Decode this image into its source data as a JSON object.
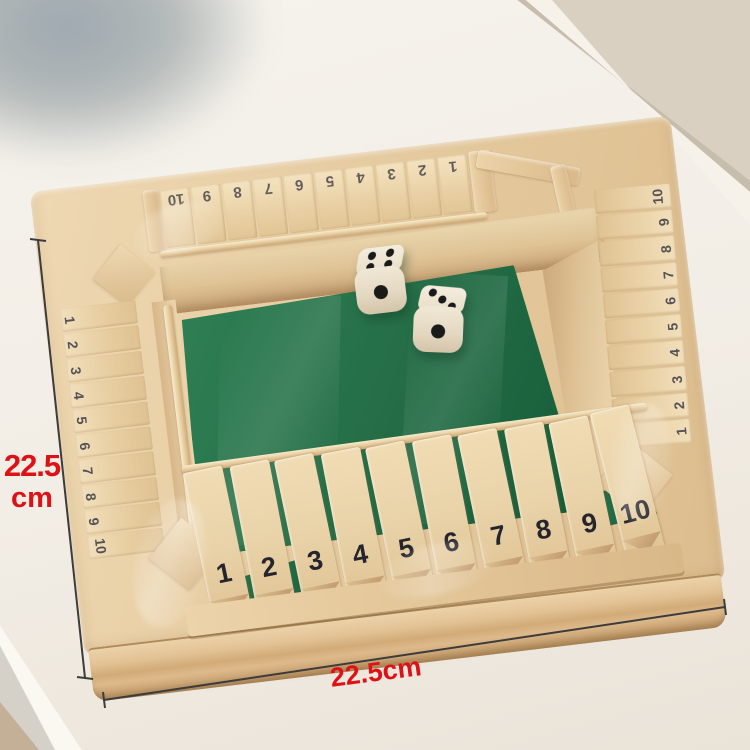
{
  "annotations": {
    "height_label": {
      "value": "22.5",
      "unit": "cm"
    },
    "width_label": {
      "text": "22.5cm"
    },
    "label_color": "#de1216",
    "line_color": "#3c3c3c"
  },
  "board": {
    "tiles": {
      "top": [
        "10",
        "9",
        "8",
        "7",
        "6",
        "5",
        "4",
        "3",
        "2",
        "1"
      ],
      "left": [
        "1",
        "2",
        "3",
        "4",
        "5",
        "6",
        "7",
        "8",
        "9",
        "10"
      ],
      "right": [
        "10",
        "9",
        "8",
        "7",
        "6",
        "5",
        "4",
        "3",
        "2",
        "1"
      ],
      "bottom": [
        "1",
        "2",
        "3",
        "4",
        "5",
        "6",
        "7",
        "8",
        "9",
        "10"
      ]
    },
    "dice": [
      {
        "top_face": 4,
        "front_face": 1
      },
      {
        "top_face": 3,
        "front_face": 1
      }
    ],
    "colors": {
      "wood_light": "#eed8b2",
      "wood_mid": "#e3c596",
      "wood_shadow": "#c9a271",
      "felt_green": "#256e47",
      "felt_green_light": "#2f8054",
      "number_ink": "#2a2a32",
      "die_body": "#ece3d0",
      "die_pip": "#1a1a1a"
    }
  }
}
